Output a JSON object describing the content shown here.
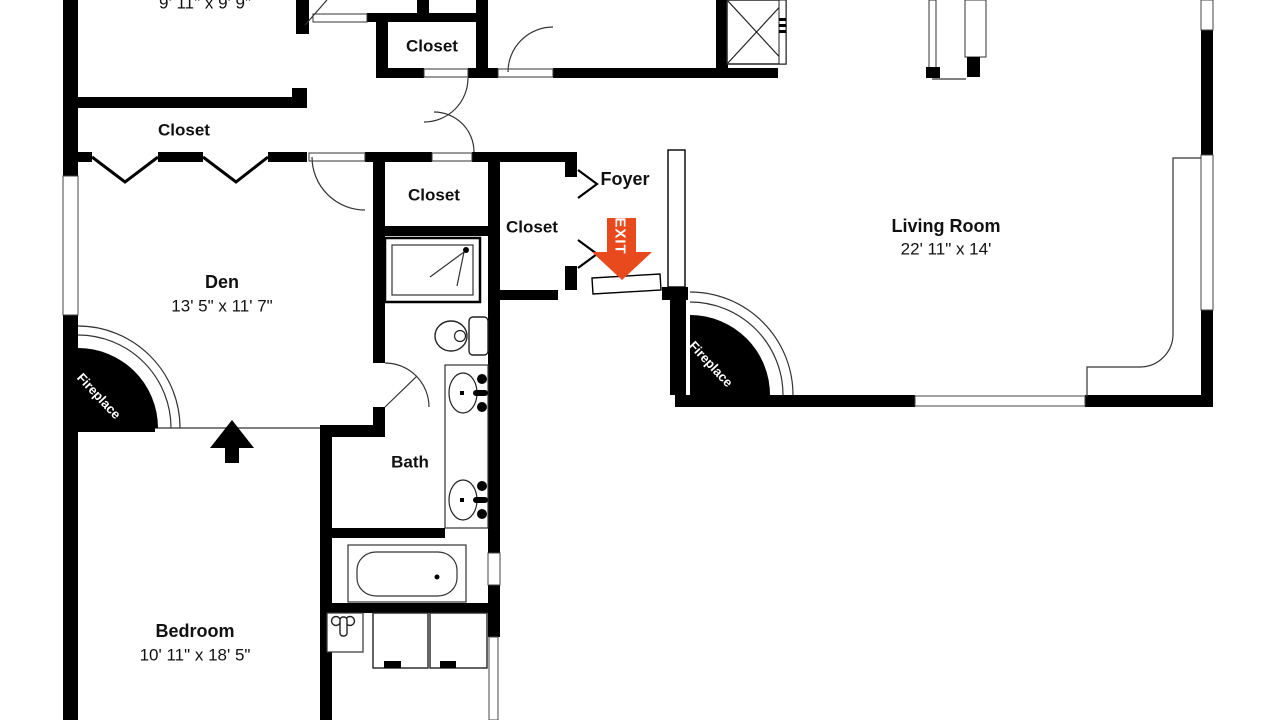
{
  "plan": {
    "background": "#ffffff",
    "wall_color": "#000000",
    "accent_color": "#e8491d",
    "line_color": "#333333"
  },
  "rooms": {
    "top_room": {
      "dims": "9' 11\" x 9' 9\""
    },
    "den_closet": {
      "name": "Closet"
    },
    "hall_closet_upper": {
      "name": "Closet"
    },
    "hall_closet_lower": {
      "name": "Closet"
    },
    "foyer_closet": {
      "name": "Closet"
    },
    "foyer": {
      "name": "Foyer"
    },
    "living_room": {
      "name": "Living Room",
      "dims": "22' 11\" x 14'"
    },
    "den": {
      "name": "Den",
      "dims": "13' 5\" x 11' 7\""
    },
    "bath": {
      "name": "Bath"
    },
    "bedroom": {
      "name": "Bedroom",
      "dims": "10' 11\" x 18' 5\""
    }
  },
  "labels": {
    "fireplace_den": "Fireplace",
    "fireplace_living": "Fireplace",
    "exit": "EXIT"
  }
}
